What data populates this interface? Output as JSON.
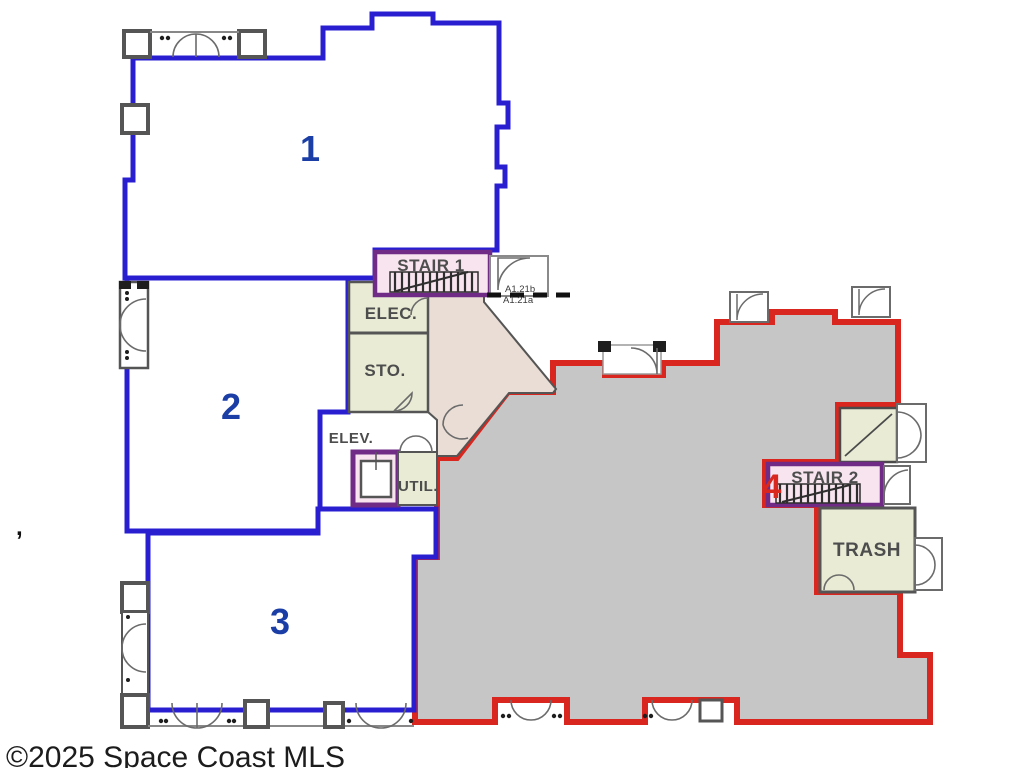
{
  "page": {
    "copyright": "©2025 Space Coast MLS",
    "stray_mark": ","
  },
  "units": {
    "1": {
      "label": "1",
      "outline_color": "#2a1fd0",
      "label_color": "#1b3ea6",
      "fill": "#ffffff"
    },
    "2": {
      "label": "2",
      "outline_color": "#2a1fd0",
      "label_color": "#1b3ea6",
      "fill": "#ffffff"
    },
    "3": {
      "label": "3",
      "outline_color": "#2a1fd0",
      "label_color": "#1b3ea6",
      "fill": "#ffffff"
    },
    "4": {
      "label": "4",
      "outline_color": "#d9261e",
      "label_color": "#d9261e",
      "fill": "#c6c6c6"
    }
  },
  "rooms": {
    "stair1": {
      "label": "STAIR 1"
    },
    "elec": {
      "label": "ELEC."
    },
    "sto": {
      "label": "STO."
    },
    "elev": {
      "label": "ELEV."
    },
    "util": {
      "label": "UTIL."
    },
    "stair2": {
      "label": "STAIR 2"
    },
    "trash": {
      "label": "TRASH"
    }
  },
  "annotations": {
    "detail_ref_top": "A1.21b",
    "detail_ref_bottom": "A1.21a"
  },
  "colors": {
    "unit_blue": "#2a1fd0",
    "unit_red": "#d9261e",
    "room_pink": "#f7e4ee",
    "room_beige": "#e9ebd5",
    "corridor_tan": "#e9ddd5",
    "area4_gray": "#c6c6c6",
    "wall_gray": "#555555",
    "elevator_purple": "#6f2b86",
    "label_gray": "#4d4d4d"
  }
}
